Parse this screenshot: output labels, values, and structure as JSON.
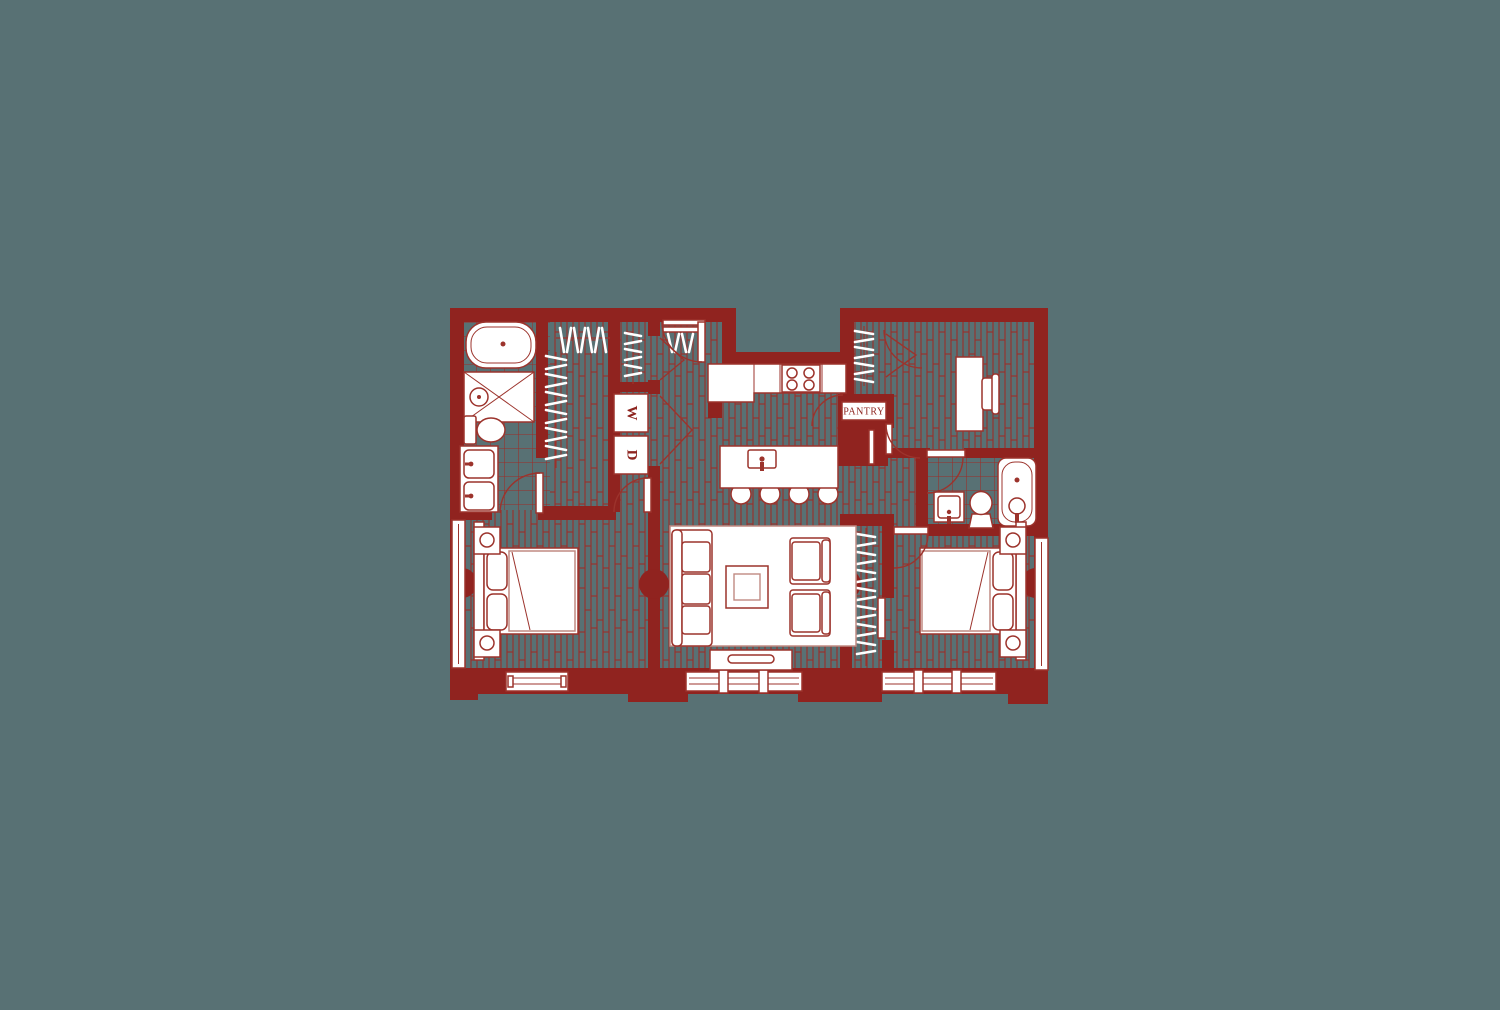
{
  "scene": {
    "name": "apartment-floor-plan",
    "description": "Two bedroom with den residential floor plan, dark red linework on teal background"
  },
  "palette": {
    "background": "#587174",
    "wall_red": "#90231f",
    "texture_line_red": "#9b2d28",
    "fixture_outline_red": "#9c332c",
    "light_outline_red": "#c08a82",
    "fixture_fill": "#ffffff"
  },
  "labels": {
    "pantry": "PANTRY",
    "washer": "W",
    "dryer": "D"
  }
}
